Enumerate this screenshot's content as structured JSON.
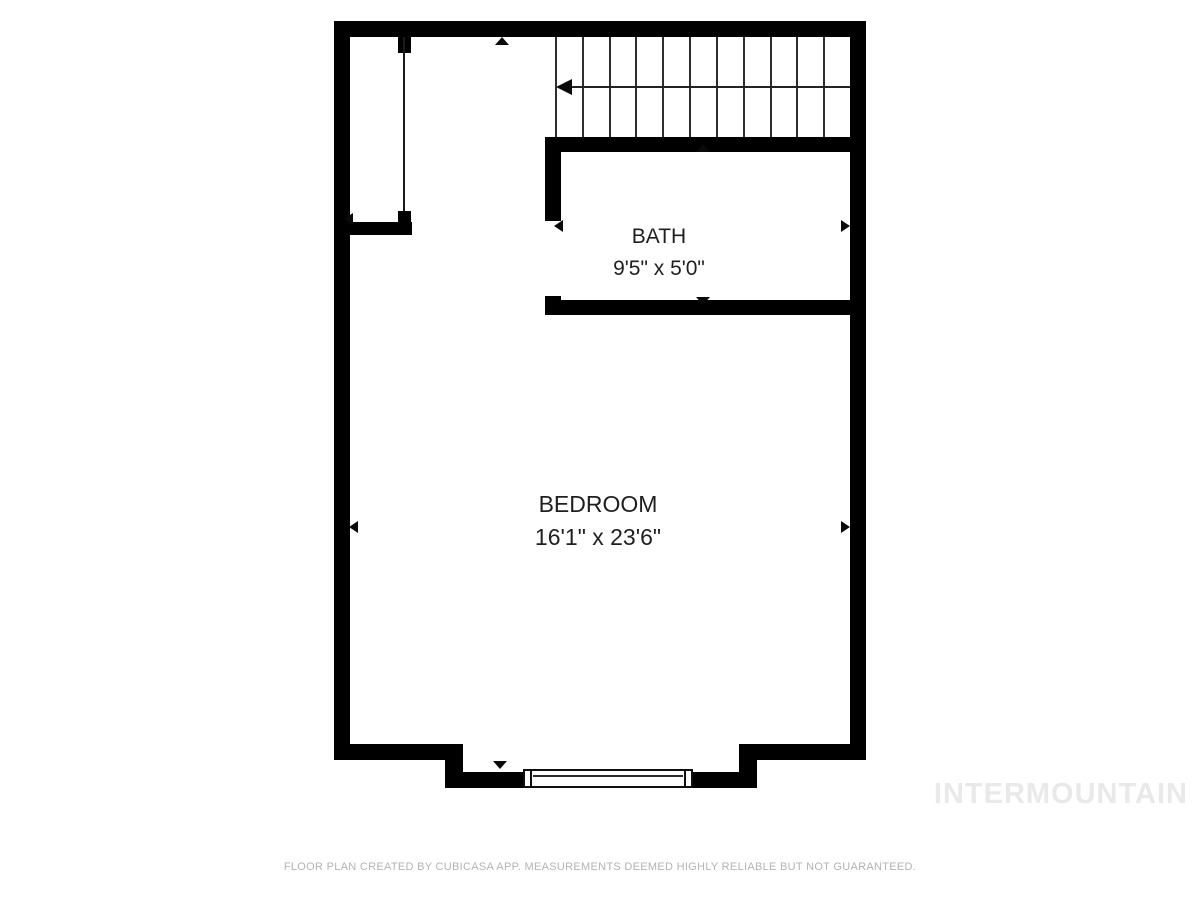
{
  "plan": {
    "rooms": [
      {
        "name": "BATH",
        "dimensions": "9'5\" x 5'0\""
      },
      {
        "name": "BEDROOM",
        "dimensions": "16'1\" x 23'6\""
      }
    ],
    "stairs": {
      "tread_count": 11,
      "direction": "left"
    }
  },
  "footer": {
    "disclaimer": "FLOOR PLAN CREATED BY CUBICASA APP. MEASUREMENTS DEEMED HIGHLY RELIABLE BUT NOT GUARANTEED."
  },
  "watermark": {
    "text": "INTERMOUNTAIN"
  },
  "colors": {
    "background": "#ffffff",
    "wall": "#000000",
    "stair_line": "#2e2e2e",
    "room_label": "#1f1f1f",
    "footer_text": "#b3b3b3",
    "watermark_text": "#e9e9e9"
  }
}
